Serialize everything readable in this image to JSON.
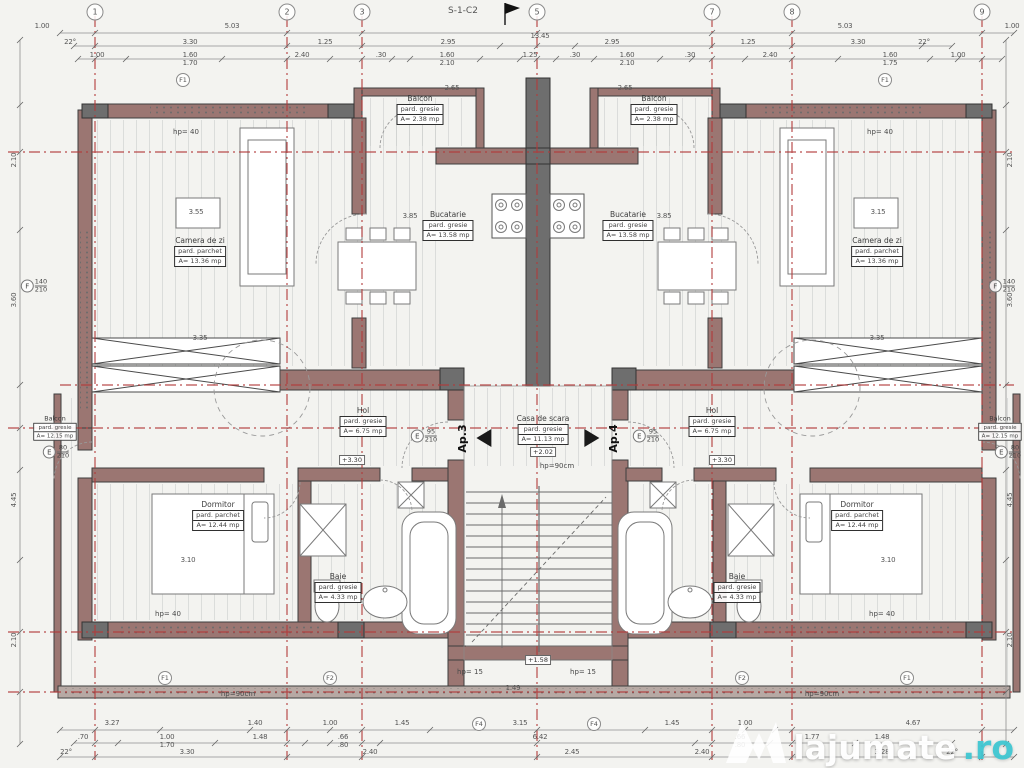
{
  "title": {
    "text": "S-1-C2"
  },
  "watermark": {
    "brand": "lajumate",
    "tld": ".ro"
  },
  "colors": {
    "axis_red": "#b23a3a",
    "wall_fill": "#9b7672",
    "wall_dark": "#6e6e6e",
    "teal": "#3fc6d1"
  },
  "grid": {
    "top": [
      {
        "n": "1",
        "x": 95
      },
      {
        "n": "2",
        "x": 287
      },
      {
        "n": "3",
        "x": 362
      },
      {
        "n": "5",
        "x": 537
      },
      {
        "n": "7",
        "x": 712
      },
      {
        "n": "8",
        "x": 792
      },
      {
        "n": "9",
        "x": 982
      }
    ],
    "aux": [
      {
        "n": "F1",
        "x": 183,
        "y": 80
      },
      {
        "n": "F1",
        "x": 885,
        "y": 80
      },
      {
        "n": "F1",
        "x": 165,
        "y": 678
      },
      {
        "n": "F2",
        "x": 330,
        "y": 678
      },
      {
        "n": "F2",
        "x": 742,
        "y": 678
      },
      {
        "n": "F1",
        "x": 907,
        "y": 678
      },
      {
        "n": "F4",
        "x": 479,
        "y": 724
      },
      {
        "n": "F4",
        "x": 594,
        "y": 724
      }
    ]
  },
  "rooms": [
    {
      "n": "Camera de zi",
      "f": "pard. parchet",
      "a": "A= 13.36 mp",
      "x": 200,
      "y": 236
    },
    {
      "n": "Camera de zi",
      "f": "pard. parchet",
      "a": "A= 13.36 mp",
      "x": 877,
      "y": 236
    },
    {
      "n": "Bucatarie",
      "f": "pard. gresie",
      "a": "A= 13.58 mp",
      "x": 448,
      "y": 210
    },
    {
      "n": "Bucatarie",
      "f": "pard. gresie",
      "a": "A= 13.58 mp",
      "x": 628,
      "y": 210
    },
    {
      "n": "Balcon",
      "f": "pard. gresie",
      "a": "A= 2.38 mp",
      "x": 420,
      "y": 94
    },
    {
      "n": "Balcon",
      "f": "pard. gresie",
      "a": "A= 2.38 mp",
      "x": 654,
      "y": 94
    },
    {
      "n": "Balcon",
      "f": "pard. gresie",
      "a": "A= 12.15 mp",
      "x": 55,
      "y": 412,
      "sm": true
    },
    {
      "n": "Balcon",
      "f": "pard. gresie",
      "a": "A= 12.15 mp",
      "x": 1000,
      "y": 412,
      "sm": true
    },
    {
      "n": "Hol",
      "f": "pard. gresie",
      "a": "A= 6.75 mp",
      "x": 363,
      "y": 406
    },
    {
      "n": "Hol",
      "f": "pard. gresie",
      "a": "A= 6.75 mp",
      "x": 712,
      "y": 406
    },
    {
      "n": "Dormitor",
      "f": "pard. parchet",
      "a": "A= 12.44 mp",
      "x": 218,
      "y": 500
    },
    {
      "n": "Dormitor",
      "f": "pard. parchet",
      "a": "A= 12.44 mp",
      "x": 857,
      "y": 500
    },
    {
      "n": "Baie",
      "f": "pard. gresie",
      "a": "A= 4.33 mp",
      "x": 338,
      "y": 572
    },
    {
      "n": "Baie",
      "f": "pard. gresie",
      "a": "A= 4.33 mp",
      "x": 737,
      "y": 572
    },
    {
      "n": "Casa de scara",
      "f": "pard. gresie",
      "a": "A= 11.13 mp",
      "x": 543,
      "y": 414
    }
  ],
  "levels": [
    {
      "t": "+2.02",
      "x": 543,
      "y": 452
    },
    {
      "t": "+3.30",
      "x": 352,
      "y": 460
    },
    {
      "t": "+3.30",
      "x": 722,
      "y": 460
    },
    {
      "t": "+1.58",
      "x": 538,
      "y": 660
    }
  ],
  "notes": [
    {
      "t": "hp= 40",
      "x": 186,
      "y": 132
    },
    {
      "t": "hp= 40",
      "x": 880,
      "y": 132
    },
    {
      "t": "hp= 40",
      "x": 168,
      "y": 614
    },
    {
      "t": "hp= 40",
      "x": 882,
      "y": 614
    },
    {
      "t": "hp= 15",
      "x": 470,
      "y": 672
    },
    {
      "t": "hp= 15",
      "x": 583,
      "y": 672
    },
    {
      "t": "hp=90cm",
      "x": 557,
      "y": 466
    },
    {
      "t": "hp=90cm",
      "x": 238,
      "y": 694
    },
    {
      "t": "hp=90cm",
      "x": 822,
      "y": 694
    }
  ],
  "tags": [
    {
      "letter": "F",
      "top": "140",
      "bot": "210",
      "x": 34,
      "y": 286
    },
    {
      "letter": "F",
      "top": "140",
      "bot": "210",
      "x": 1002,
      "y": 286
    },
    {
      "letter": "E",
      "top": "80",
      "bot": "210",
      "x": 56,
      "y": 452
    },
    {
      "letter": "E",
      "top": "80",
      "bot": "210",
      "x": 1008,
      "y": 452
    },
    {
      "letter": "E",
      "top": "95",
      "bot": "210",
      "x": 424,
      "y": 436
    },
    {
      "letter": "E",
      "top": "95",
      "bot": "210",
      "x": 646,
      "y": 436
    }
  ],
  "apartments": [
    {
      "label": "Ap.3",
      "x": 470,
      "y": 438,
      "dir": "left"
    },
    {
      "label": "Ap.4",
      "x": 606,
      "y": 438,
      "dir": "right"
    }
  ],
  "dims": {
    "labels": [
      {
        "t": "1.00",
        "x": 42,
        "y": 26
      },
      {
        "t": "5.03",
        "x": 232,
        "y": 26
      },
      {
        "t": "13.45",
        "x": 540,
        "y": 36
      },
      {
        "t": "5.03",
        "x": 845,
        "y": 26
      },
      {
        "t": "1.00",
        "x": 1012,
        "y": 26
      },
      {
        "t": "22°",
        "x": 70,
        "y": 42
      },
      {
        "t": "3.30",
        "x": 190,
        "y": 42
      },
      {
        "t": "1.25",
        "x": 325,
        "y": 42
      },
      {
        "t": "2.95",
        "x": 448,
        "y": 42
      },
      {
        "t": "2.95",
        "x": 612,
        "y": 42
      },
      {
        "t": "1.25",
        "x": 748,
        "y": 42
      },
      {
        "t": "3.30",
        "x": 858,
        "y": 42
      },
      {
        "t": "22°",
        "x": 924,
        "y": 42
      },
      {
        "t": "1.00",
        "x": 97,
        "y": 55
      },
      {
        "t": "1.60",
        "x": 190,
        "y": 55,
        "s": "1.70"
      },
      {
        "t": "2.40",
        "x": 302,
        "y": 55
      },
      {
        "t": ".30",
        "x": 381,
        "y": 55
      },
      {
        "t": "1.60",
        "x": 447,
        "y": 55,
        "s": "2.10"
      },
      {
        "t": "1.25",
        "x": 530,
        "y": 55
      },
      {
        "t": ".30",
        "x": 575,
        "y": 55
      },
      {
        "t": "1.60",
        "x": 627,
        "y": 55,
        "s": "2.10"
      },
      {
        "t": ".30",
        "x": 690,
        "y": 55
      },
      {
        "t": "2.40",
        "x": 770,
        "y": 55
      },
      {
        "t": "1.60",
        "x": 890,
        "y": 55,
        "s": "1.75"
      },
      {
        "t": "1.00",
        "x": 958,
        "y": 55
      },
      {
        "t": "3.27",
        "x": 112,
        "y": 723
      },
      {
        "t": "1.40",
        "x": 255,
        "y": 723
      },
      {
        "t": "1.00",
        "x": 330,
        "y": 723
      },
      {
        "t": "1.45",
        "x": 402,
        "y": 723
      },
      {
        "t": "3.15",
        "x": 520,
        "y": 723
      },
      {
        "t": "1.45",
        "x": 672,
        "y": 723
      },
      {
        "t": "1.00",
        "x": 745,
        "y": 723
      },
      {
        "t": "4.67",
        "x": 913,
        "y": 723
      },
      {
        "t": ".70",
        "x": 83,
        "y": 737
      },
      {
        "t": "1.00",
        "x": 167,
        "y": 737,
        "s": "1.70"
      },
      {
        "t": "1.48",
        "x": 260,
        "y": 737
      },
      {
        "t": ".66",
        "x": 343,
        "y": 737,
        "s": ".80"
      },
      {
        "t": "6.42",
        "x": 540,
        "y": 737
      },
      {
        "t": ".66",
        "x": 740,
        "y": 737,
        "s": ".80"
      },
      {
        "t": "1.77",
        "x": 812,
        "y": 737
      },
      {
        "t": "1.48",
        "x": 882,
        "y": 737
      },
      {
        "t": "22°",
        "x": 66,
        "y": 752
      },
      {
        "t": "3.30",
        "x": 187,
        "y": 752
      },
      {
        "t": "2.40",
        "x": 370,
        "y": 752
      },
      {
        "t": "2.45",
        "x": 572,
        "y": 752
      },
      {
        "t": "2.40",
        "x": 702,
        "y": 752
      },
      {
        "t": "3.28",
        "x": 882,
        "y": 752
      },
      {
        "t": "22°",
        "x": 952,
        "y": 752
      },
      {
        "t": "2.10",
        "x": 14,
        "y": 160,
        "r": 1
      },
      {
        "t": "3.60",
        "x": 14,
        "y": 300,
        "r": 1
      },
      {
        "t": "4.45",
        "x": 14,
        "y": 500,
        "r": 1
      },
      {
        "t": "2.10",
        "x": 14,
        "y": 640,
        "r": 1
      },
      {
        "t": "2.10",
        "x": 1010,
        "y": 160,
        "r": 1
      },
      {
        "t": "3.60",
        "x": 1010,
        "y": 300,
        "r": 1
      },
      {
        "t": "4.45",
        "x": 1010,
        "y": 500,
        "r": 1
      },
      {
        "t": "2.10",
        "x": 1010,
        "y": 640,
        "r": 1
      },
      {
        "t": "3.55",
        "x": 196,
        "y": 212
      },
      {
        "t": "3.15",
        "x": 878,
        "y": 212
      },
      {
        "t": "3.85",
        "x": 410,
        "y": 216
      },
      {
        "t": "3.85",
        "x": 664,
        "y": 216
      },
      {
        "t": "3.35",
        "x": 200,
        "y": 338
      },
      {
        "t": "3.35",
        "x": 877,
        "y": 338
      },
      {
        "t": "3.10",
        "x": 188,
        "y": 560
      },
      {
        "t": "3.10",
        "x": 888,
        "y": 560
      },
      {
        "t": "2.65",
        "x": 452,
        "y": 88
      },
      {
        "t": "2.65",
        "x": 625,
        "y": 88
      },
      {
        "t": "1.49",
        "x": 513,
        "y": 688
      }
    ]
  }
}
